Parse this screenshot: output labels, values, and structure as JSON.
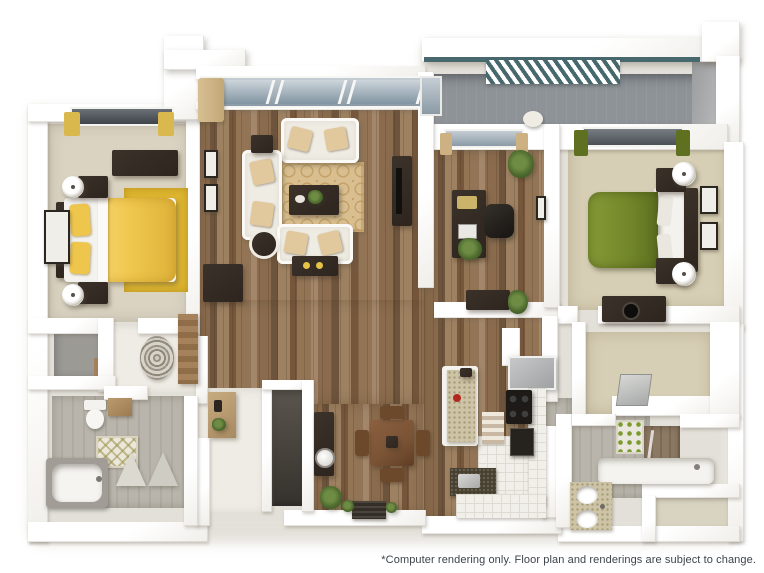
{
  "footer": {
    "disclaimer": "*Computer rendering only. Floor plan and renderings are subject to change."
  },
  "colors": {
    "wall": "#fdfdfc",
    "wood": "#8a6b4d",
    "wood-dark": "#6e543c",
    "wood-light": "#9d8161",
    "carpet-1": "#dad3c2",
    "carpet-2": "#d7cfb5",
    "deck": "#8e9398",
    "pergola-teal": "#47696d",
    "bed-yellow": "#efc64c",
    "rug-yellow": "#ddb52f",
    "bed-green": "#74882b",
    "espresso": "#2d251e",
    "cream": "#efece4",
    "pillow-tan": "#e2c89d",
    "rug-tan": "#d9bf90",
    "tile-gray": "#b6b2a9",
    "tile-white": "#f1efe9",
    "counter-speckle": "#cdc3a5",
    "counter-dark": "#48402f",
    "table-brown": "#7a5335",
    "plant-green": "#4d6a2e",
    "text": "#3d434b"
  }
}
